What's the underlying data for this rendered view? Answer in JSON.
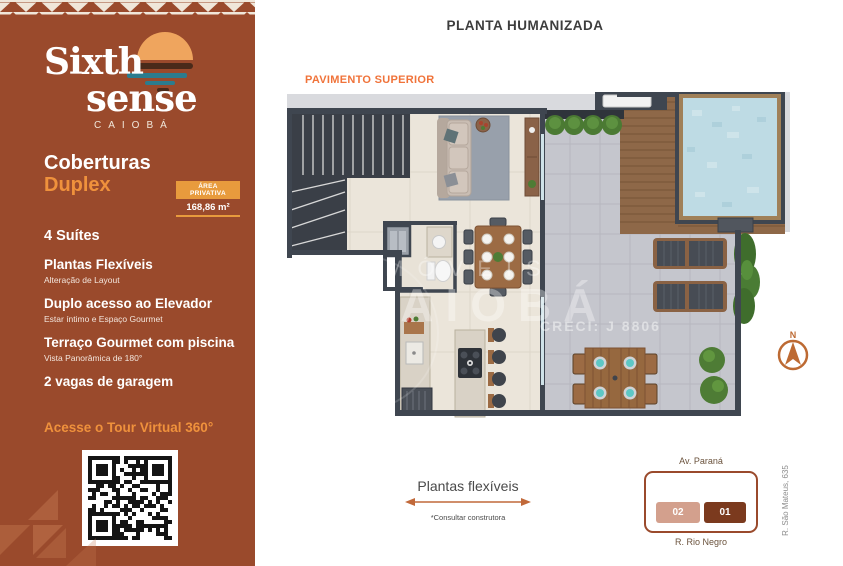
{
  "palette": {
    "sidebar_bg": "#9a4a2c",
    "accent_orange": "#ef913c",
    "badge_orange": "#e89b3d",
    "floor_label_orange": "#f0733a",
    "logo_sun_orange": "#efa55e",
    "logo_teal": "#2c7c8e",
    "pattern_cream": "#f0e7da",
    "wall_dark": "#3f4650",
    "interior_floor": "#ebe5da",
    "terrace_floor": "#c5c6cd",
    "deck_wood": "#8e6848",
    "pool_water": "#bedbe4",
    "diagram_outline": "#9a4a2c",
    "unit02_bg": "#d3a08d",
    "unit01_bg": "#7b3a1e",
    "compass_orange": "#bd6a33"
  },
  "sidebar": {
    "logo": {
      "word1": "Sixth",
      "word2": "sense",
      "subtitle": "CAIOBÁ"
    },
    "title": {
      "line1": "Coberturas",
      "line2": "Duplex"
    },
    "area_badge": {
      "label": "ÁREA PRIVATIVA",
      "value": "168,86 m²"
    },
    "suites": "4 Suítes",
    "features": [
      {
        "title": "Plantas Flexíveis",
        "subtitle": "Alteração de Layout"
      },
      {
        "title": "Duplo acesso ao Elevador",
        "subtitle": "Estar íntimo e Espaço Gourmet"
      },
      {
        "title": "Terraço Gourmet com piscina",
        "subtitle": "Vista Panorâmica de 180°"
      },
      {
        "title": "2 vagas de garagem",
        "subtitle": ""
      }
    ],
    "tour_cta": "Acesse o Tour Virtual 360°"
  },
  "main": {
    "title": "PLANTA HUMANIZADA",
    "floor_label": "PAVIMENTO SUPERIOR",
    "watermark": {
      "line1": "IMÓVEIS",
      "line2": "CAIOBÁ",
      "creci": "CRECI: J 8806"
    },
    "compass": {
      "north_label": "N"
    },
    "flexible_note": {
      "title": "Plantas flexíveis",
      "subtitle": "*Consultar construtora"
    },
    "location": {
      "street_top": "Av. Paraná",
      "street_bottom": "R. Rio Negro",
      "street_right": "R. São Mateus, 635",
      "units": [
        {
          "label": "02"
        },
        {
          "label": "01"
        }
      ],
      "highlighted_unit": "01"
    }
  }
}
